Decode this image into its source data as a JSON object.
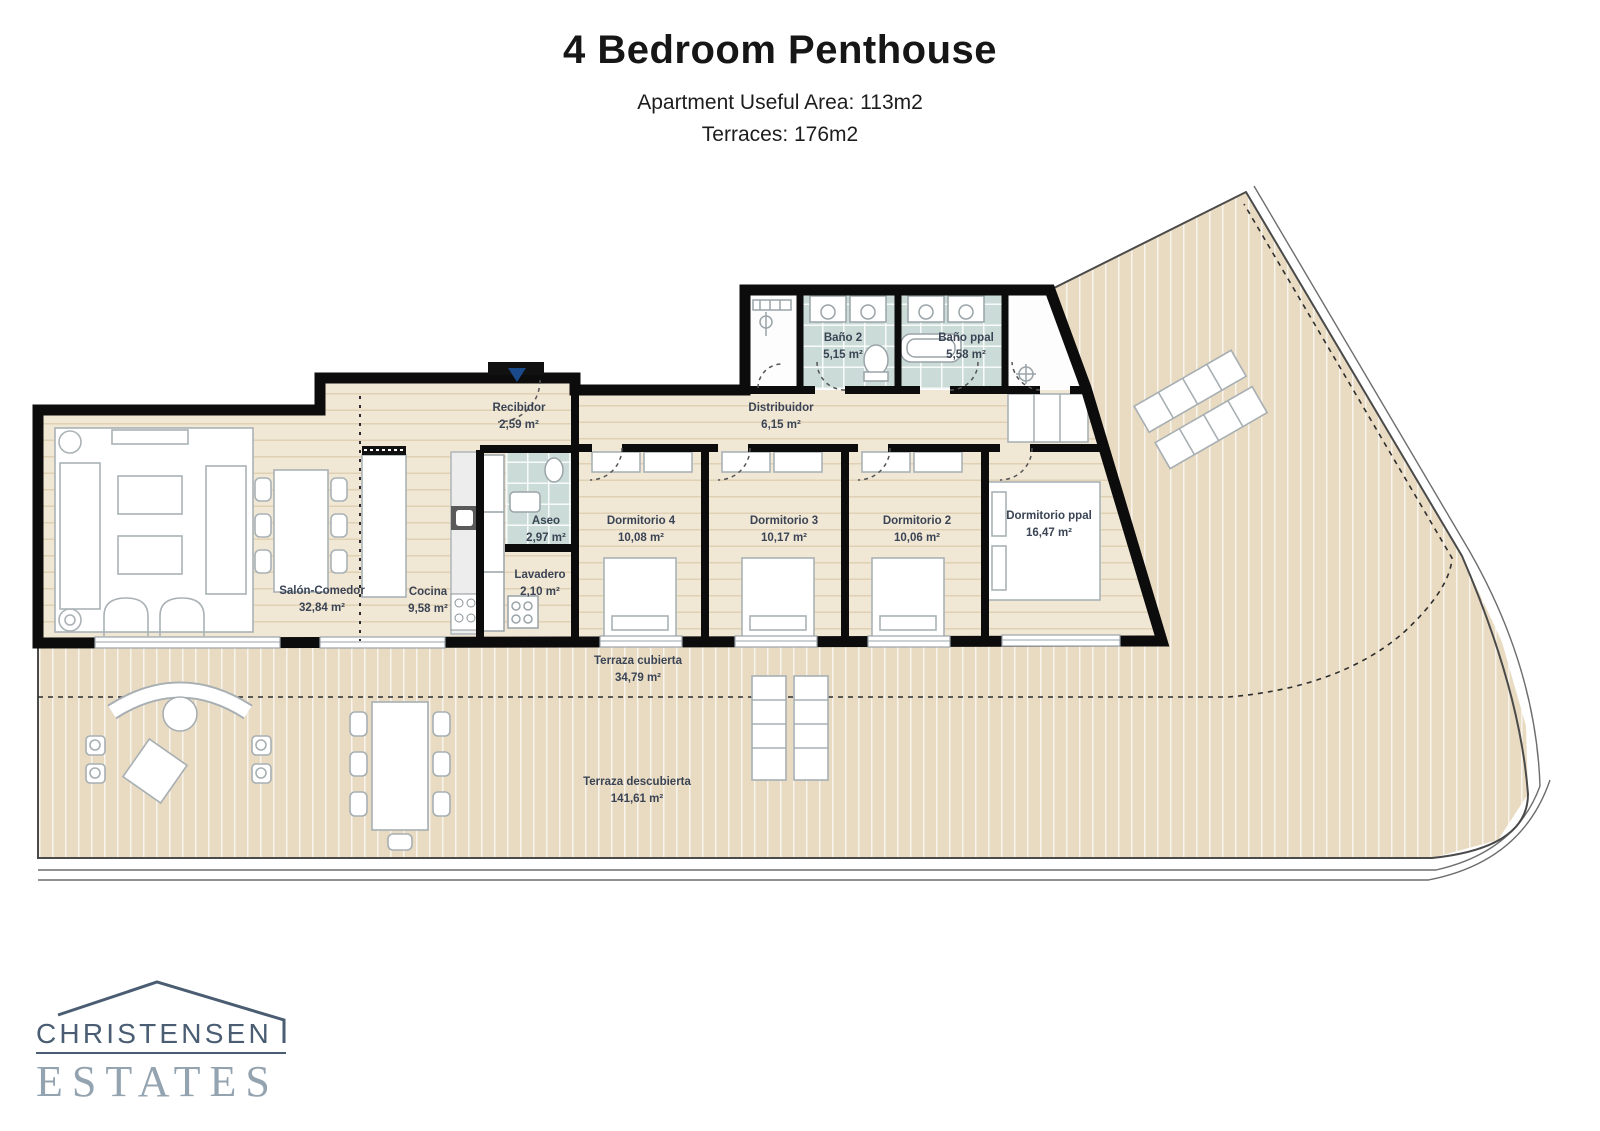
{
  "header": {
    "title": "4 Bedroom Penthouse",
    "subtitle1": "Apartment Useful Area:  113m2",
    "subtitle2": "Terraces: 176m2"
  },
  "rooms": [
    {
      "name": "Salón-Comedor",
      "area": "32,84 m²"
    },
    {
      "name": "Cocina",
      "area": "9,58 m²"
    },
    {
      "name": "Recibidor",
      "area": "2,59 m²"
    },
    {
      "name": "Distribuidor",
      "area": "6,15 m²"
    },
    {
      "name": "Aseo",
      "area": "2,97 m²"
    },
    {
      "name": "Lavadero",
      "area": "2,10 m²"
    },
    {
      "name": "Baño 2",
      "area": "5,15 m²"
    },
    {
      "name": "Baño ppal",
      "area": "5,58 m²"
    },
    {
      "name": "Dormitorio 4",
      "area": "10,08 m²"
    },
    {
      "name": "Dormitorio 3",
      "area": "10,17 m²"
    },
    {
      "name": "Dormitorio 2",
      "area": "10,06 m²"
    },
    {
      "name": "Dormitorio ppal",
      "area": "16,47 m²"
    },
    {
      "name": "Terraza cubierta",
      "area": "34,79 m²"
    },
    {
      "name": "Terraza descubierta",
      "area": "141,61 m²"
    }
  ],
  "logo": {
    "line1": "CHRISTENSEN",
    "line2": "ESTATES"
  },
  "colors": {
    "wall": "#0c0c0c",
    "deck": "#e9dbc2",
    "interior_floor": "#f1e7d5",
    "bath_floor": "#cbdcd8",
    "label_text": "#3a4454",
    "logo_primary": "#4a5d72",
    "logo_secondary": "#94a3b0"
  }
}
